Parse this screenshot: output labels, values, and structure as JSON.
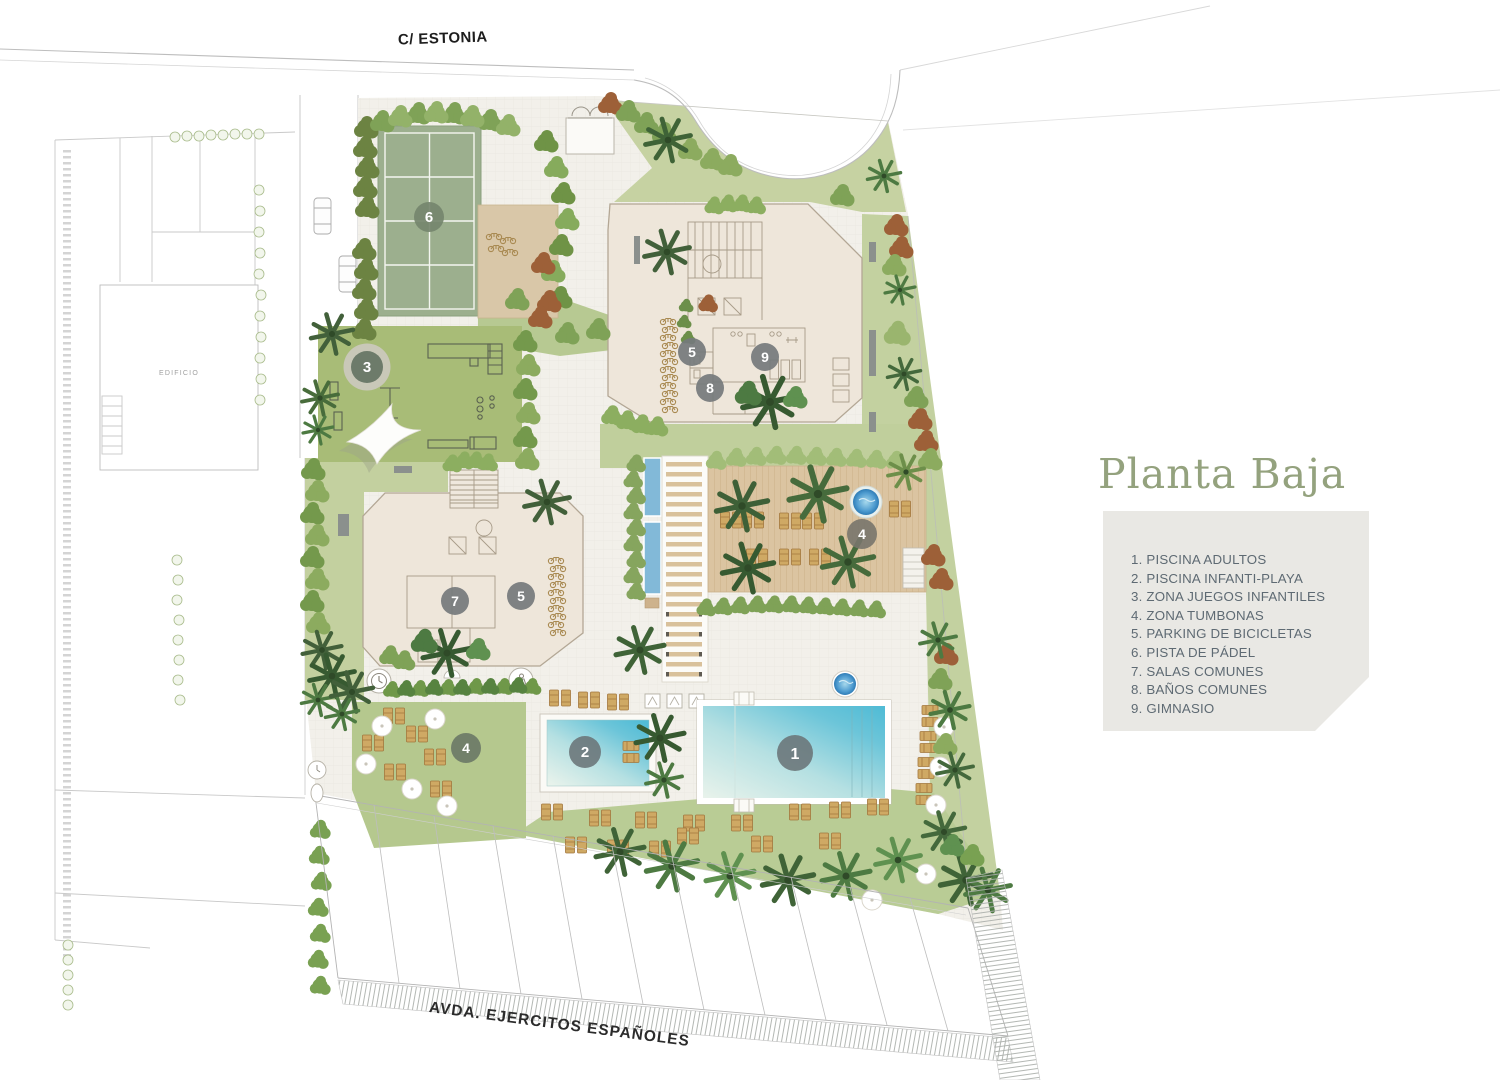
{
  "title": "Planta Baja",
  "streets": {
    "top": "C/ ESTONIA",
    "bottom": "AVDA. EJERCITOS ESPAÑOLES"
  },
  "neighbor": {
    "label": "EDIFICIO"
  },
  "legend": {
    "items": [
      {
        "text": "1. PISCINA ADULTOS"
      },
      {
        "text": "2. PISCINA INFANTI-PLAYA"
      },
      {
        "text": "3. ZONA JUEGOS INFANTILES"
      },
      {
        "text": "4. ZONA TUMBONAS"
      },
      {
        "text": "5. PARKING DE BICICLETAS"
      },
      {
        "text": "6. PISTA DE PÁDEL"
      },
      {
        "text": "7. SALAS COMUNES"
      },
      {
        "text": "8. BAÑOS COMUNES"
      },
      {
        "text": "9. GIMNASIO"
      }
    ]
  },
  "markers": {
    "pool_adult": "1",
    "pool_infant": "2",
    "playground": "3",
    "tumbonas_deck": "4",
    "tumbonas_lawn": "4",
    "bikes_north": "5",
    "bikes_south": "5",
    "padel": "6",
    "salas": "7",
    "banos": "8",
    "gimnasio": "9"
  },
  "colors": {
    "title_green": "#94a27e",
    "legend_bg": "#e9e8e4",
    "legend_text": "#5e6a73",
    "lawn": "#c3d1a0",
    "playground_green": "#a8bc77",
    "padel_green": "#9caf8e",
    "deck_wood": "#dbc4a1",
    "pool_blue": "#52bcd6",
    "marker_gray": "#757a7c"
  }
}
